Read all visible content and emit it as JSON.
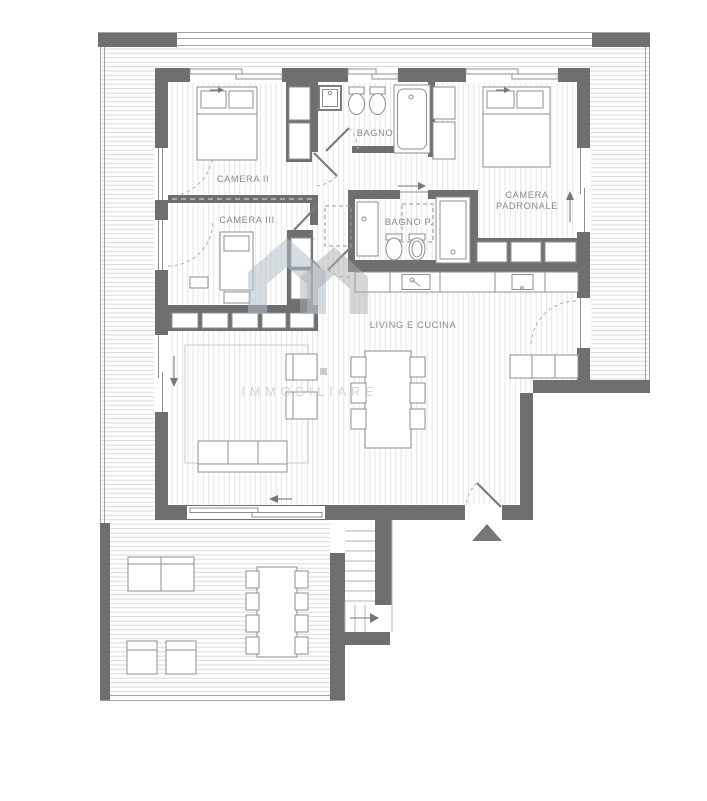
{
  "plan": {
    "type": "apartment-floor-plan",
    "labels": {
      "camera_ii": "CAMERA II",
      "camera_iii": "CAMERA III",
      "bagno": "BAGNO",
      "bagno_p": "BAGNO P.",
      "camera_padronale_line1": "CAMERA",
      "camera_padronale_line2": "PADRONALE",
      "living": "LIVING E CUCINA"
    },
    "watermark": {
      "text": "IMMOBILIARE"
    },
    "colors": {
      "wall": "#6f6f6f",
      "balcony_hatch": "#d9d9d9",
      "floor_hatch": "#e5e5e5",
      "label_text": "#8a8a8a",
      "watermark_house_blue": "#b3c1cb",
      "watermark_house_gray": "#a9aeb2",
      "watermark_text": "#d0d4d8",
      "entrance_marker": "#6f6f6f"
    }
  }
}
